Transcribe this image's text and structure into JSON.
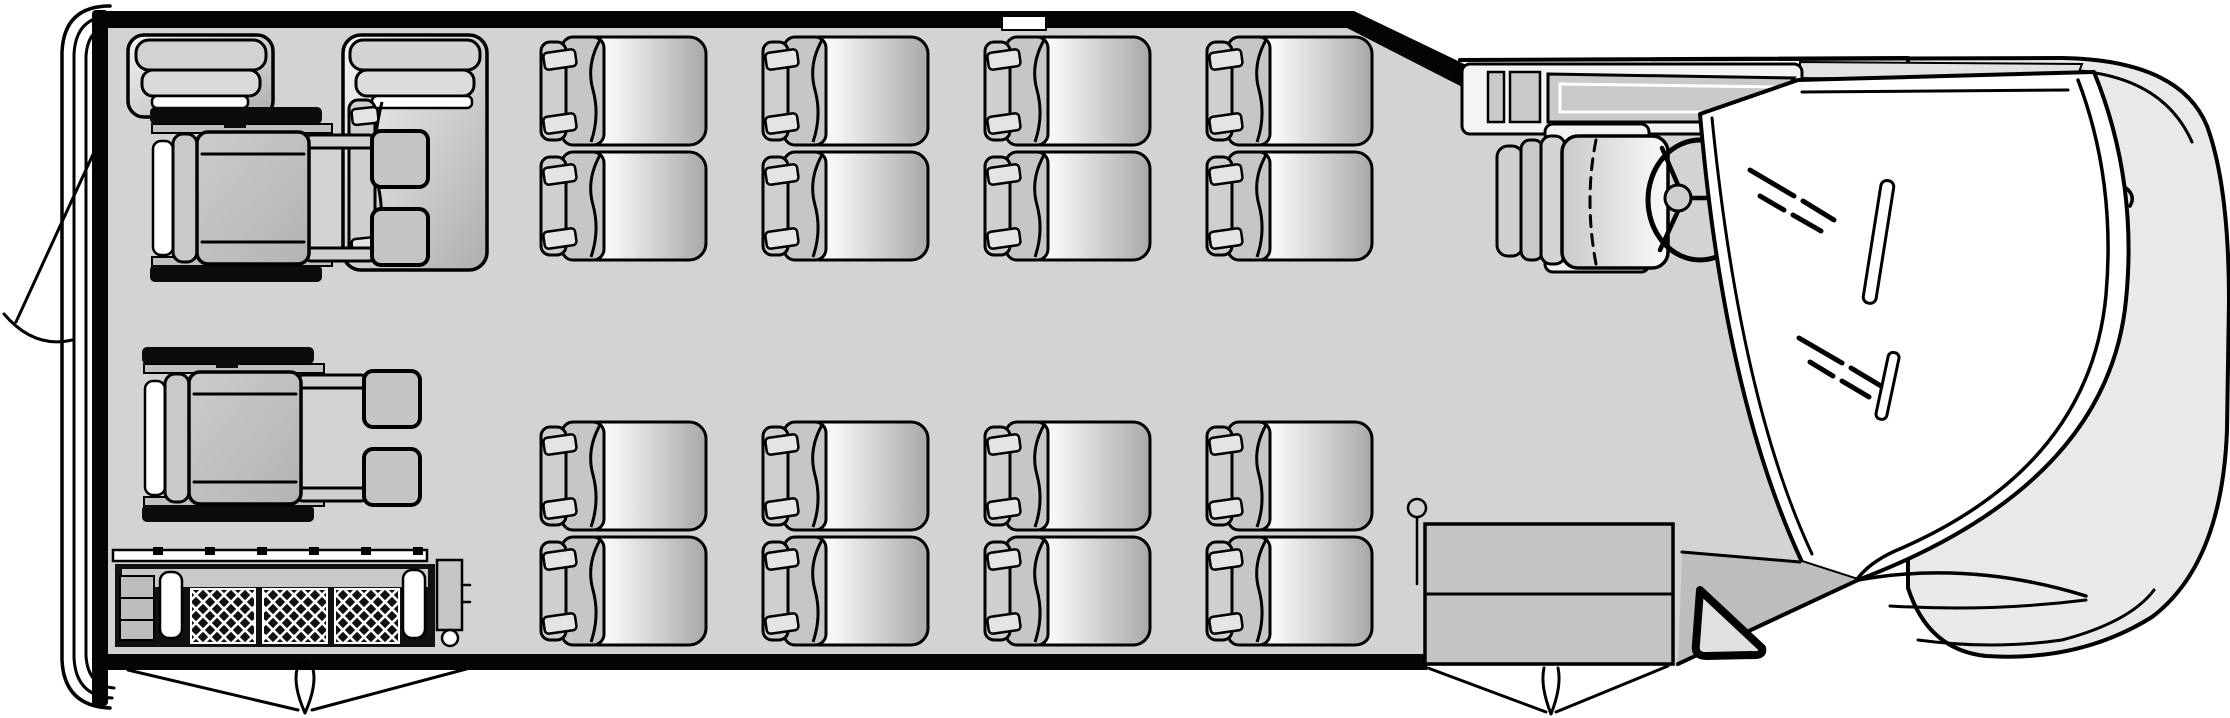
{
  "canvas": {
    "width": 2230,
    "height": 718
  },
  "palette": {
    "background": "#ffffff",
    "floor": "#d3d3d3",
    "outline": "#000000",
    "hood_body": "#e9e9e9",
    "glass": "#ffffff",
    "cowl_shadow": "#bdbdbd",
    "cowl_strip": "#e2e2e2",
    "seat_gray": "#c6c6c6",
    "cushion_dark": "#a8a8a8",
    "step_gray": "#c4c4c4",
    "dash_gray": "#c9c9c9",
    "track_black": "#0b0b0b"
  },
  "summary": {
    "view": "overhead-floor-plan",
    "vehicle_front_side": "right",
    "vehicle_rear_side": "left",
    "forward_facing_double_seat_units": 8,
    "forward_facing_passenger_seats": 16,
    "rear_side_facing_seat_units": 2,
    "wheelchair_positions": 2,
    "driver_seats": 1,
    "has_wheelchair_lift": true,
    "door_swings": [
      "rear-door",
      "lift-double-doors",
      "front-entry-double-doors"
    ]
  },
  "seat_rows": [
    {
      "id": "driver-side-row",
      "y": 33,
      "units": [
        {
          "x": 536
        },
        {
          "x": 758
        },
        {
          "x": 980
        },
        {
          "x": 1202
        }
      ]
    },
    {
      "id": "entry-side-row",
      "y": 418,
      "units": [
        {
          "x": 536
        },
        {
          "x": 758
        },
        {
          "x": 980
        },
        {
          "x": 1202
        }
      ]
    }
  ],
  "wheelchairs": [
    {
      "id": "wheelchair-position-rear-top",
      "x": 150,
      "y": 107
    },
    {
      "id": "wheelchair-position-rear-bottom",
      "x": 142,
      "y": 347
    }
  ],
  "lift": {
    "stud_xs": [
      153,
      205,
      257,
      309,
      361,
      413
    ],
    "panel_xs": [
      191,
      263,
      335
    ],
    "panel_width": 64
  }
}
